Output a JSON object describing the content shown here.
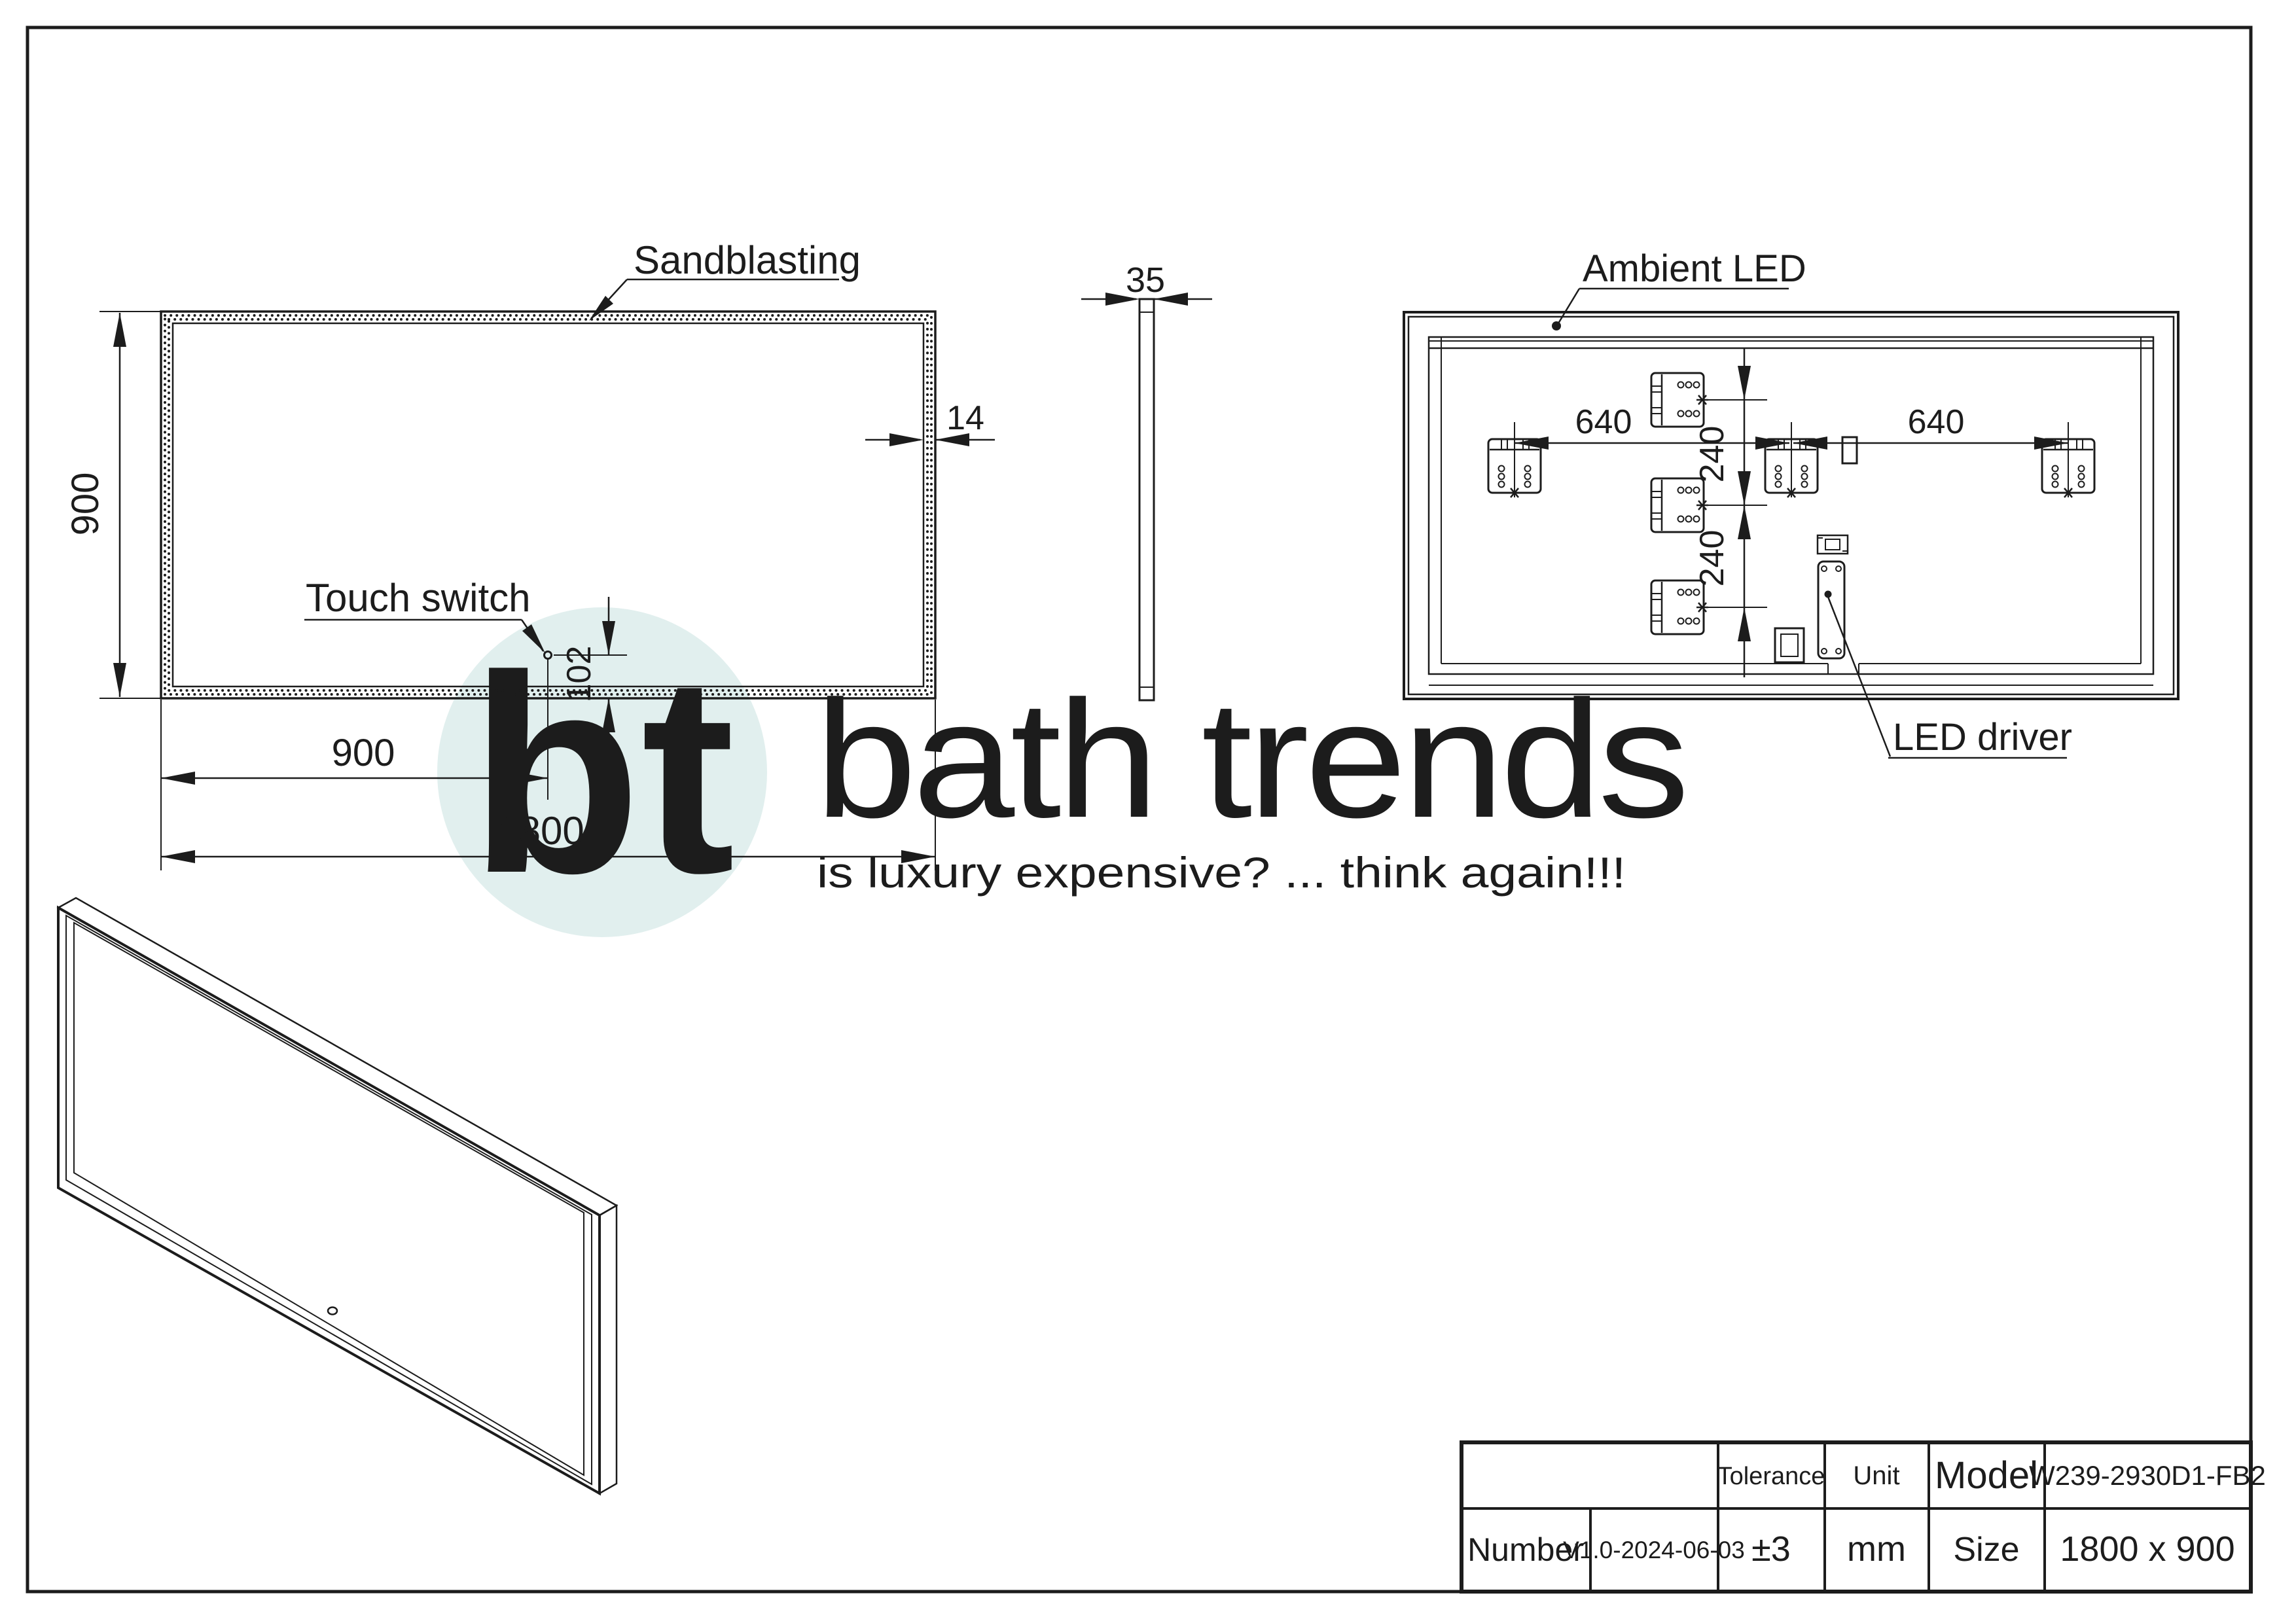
{
  "drawing": {
    "labels": {
      "sandblasting": "Sandblasting",
      "touch_switch": "Touch switch",
      "ambient_led": "Ambient LED",
      "led_driver": "LED driver"
    },
    "dimensions": {
      "front_height": "900",
      "front_width": "1800",
      "switch_from_left": "900",
      "switch_from_bottom": "102",
      "frame_width": "14",
      "thickness": "35",
      "led_span_left": "640",
      "led_span_right": "640",
      "bracket_gap_upper": "240",
      "bracket_gap_lower": "240"
    },
    "title_block": {
      "tolerance_label": "Tolerance",
      "tolerance_value": "±3",
      "unit_label": "Unit",
      "unit_value": "mm",
      "model_label": "Model",
      "model_value": "W239-2930D1-FB2",
      "number_label": "Number",
      "number_value": "V1.0-2024-06-03",
      "size_label": "Size",
      "size_value": "1800 x 900"
    },
    "watermark": {
      "initials": "bt",
      "brand": "bath trends",
      "tagline": "is luxury expensive? ... think again!!!",
      "circle_color": "#e1efee",
      "text_color": "#d7d7d7"
    }
  }
}
